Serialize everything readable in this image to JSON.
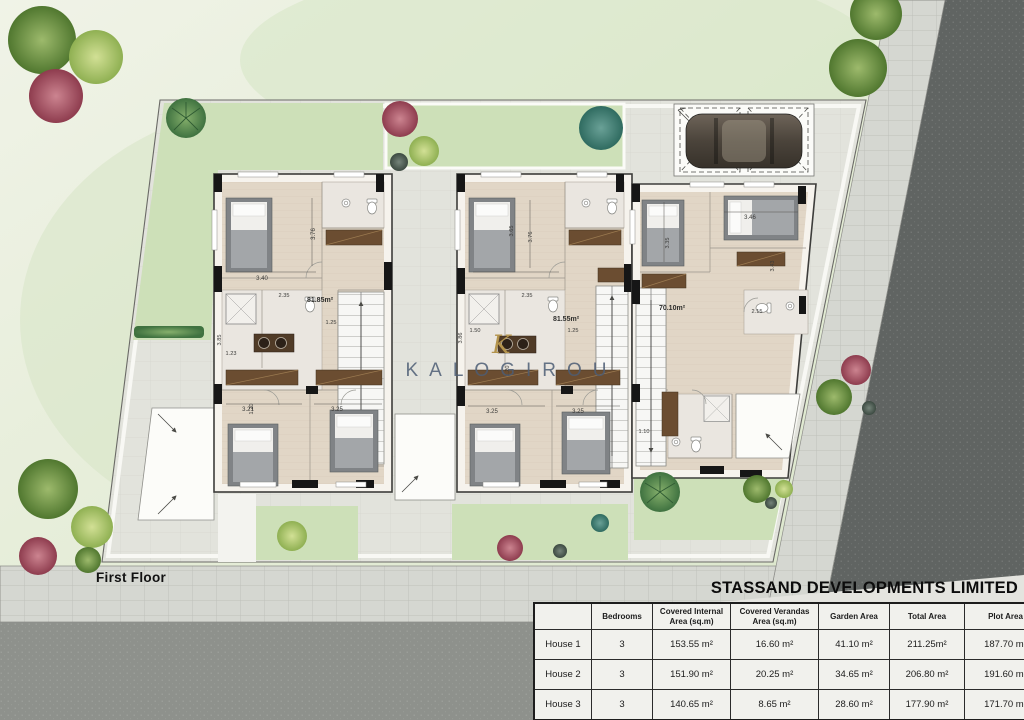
{
  "site": {
    "floor_label": "First Floor",
    "developer_title": "STASSAND DEVELOPMENTS LIMITED",
    "watermark": {
      "monogram": "K",
      "text": "KALOGIROU"
    }
  },
  "plan": {
    "house1": {
      "area": "81.85m²",
      "dim_width": "3.40",
      "dim_depth": "3.76",
      "dim_bath": "2.35",
      "dim_left": "3.85",
      "dim_123": "1.23",
      "dim_120": "1.20",
      "dim_125": "1.25",
      "dim_bed1": "3.21",
      "dim_bed2": "3.25"
    },
    "house2": {
      "area": "81.55m²",
      "dim_width": "3.65",
      "dim_depth": "3.76",
      "dim_bath": "2.35",
      "dim_left": "3.86",
      "dim_150": "1.50",
      "dim_125": "1.25",
      "dim_120": "1.20",
      "dim_bed1": "3.25",
      "dim_bed2": "3.25"
    },
    "house3": {
      "area": "70.10m²",
      "dim_width": "3.46",
      "dim_depth": "3.35",
      "dim_right": "3.43",
      "dim_215": "2.15",
      "dim_110": "1.10"
    }
  },
  "table": {
    "columns": [
      "",
      "Bedrooms",
      "Covered Internal Area (sq.m)",
      "Covered Verandas Area (sq.m)",
      "Garden Area",
      "Total Area",
      "Plot Area"
    ],
    "rows": [
      [
        "House 1",
        "3",
        "153.55 m²",
        "16.60 m²",
        "41.10 m²",
        "211.25m²",
        "187.70 m²"
      ],
      [
        "House 2",
        "3",
        "151.90 m²",
        "20.25 m²",
        "34.65 m²",
        "206.80 m²",
        "191.60 m²"
      ],
      [
        "House 3",
        "3",
        "140.65 m²",
        "8.65 m²",
        "28.60 m²",
        "177.90 m²",
        "171.70 m²"
      ]
    ]
  },
  "colors": {
    "lawn": "#cde0b8",
    "road_dark": "#606462",
    "road_light": "#8e918c",
    "floor": "#e1d6c6",
    "accent_gold": "#b3934c"
  }
}
